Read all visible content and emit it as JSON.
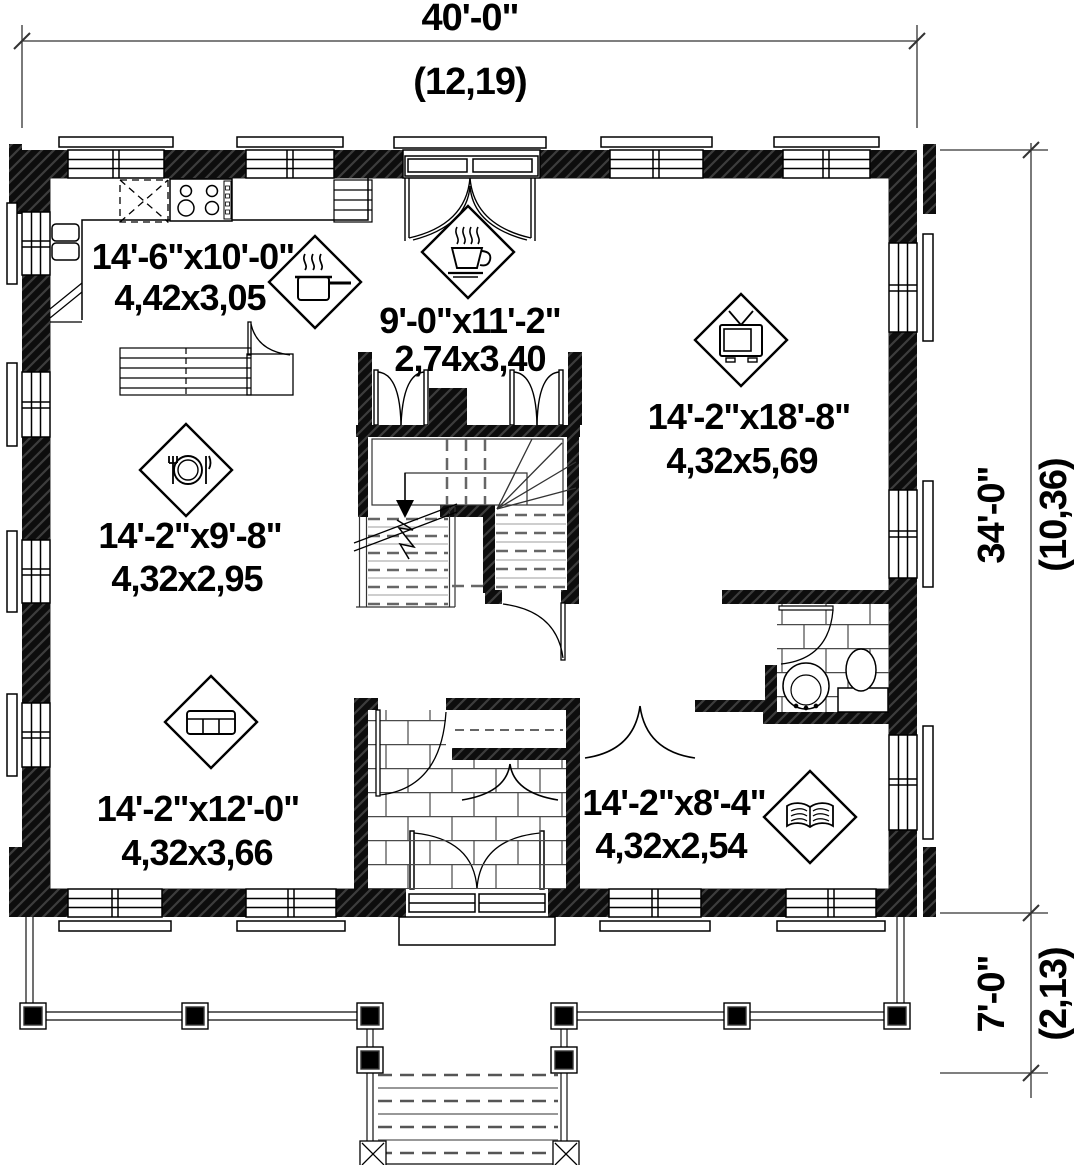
{
  "plan": {
    "type": "first-floor-plan",
    "dimensions": {
      "overall_width": {
        "imperial": "40'-0\"",
        "metric": "(12,19)"
      },
      "main_depth": {
        "imperial": "34'-0\"",
        "metric": "(10,36)"
      },
      "porch_depth": {
        "imperial": "7'-0\"",
        "metric": "(2,13)"
      }
    },
    "rooms": [
      {
        "name": "kitchen",
        "icon": "cooking-pot-icon",
        "size_imperial": "14'-6\"x10'-0\"",
        "size_metric": "4,42x3,05"
      },
      {
        "name": "breakfast-nook",
        "icon": "coffee-cup-icon",
        "size_imperial": "9'-0\"x11'-2\"",
        "size_metric": "2,74x3,40"
      },
      {
        "name": "living-room",
        "icon": "tv-icon",
        "size_imperial": "14'-2\"x18'-8\"",
        "size_metric": "4,32x5,69"
      },
      {
        "name": "dining-room",
        "icon": "dining-cutlery-icon",
        "size_imperial": "14'-2\"x9'-8\"",
        "size_metric": "4,32x2,95"
      },
      {
        "name": "family-room",
        "icon": "sofa-icon",
        "size_imperial": "14'-2\"x12'-0\"",
        "size_metric": "4,32x3,66"
      },
      {
        "name": "study",
        "icon": "open-book-icon",
        "size_imperial": "14'-2\"x8'-4\"",
        "size_metric": "4,32x2,54"
      }
    ],
    "colors": {
      "wall": "#0d0d0d",
      "line": "#000000",
      "background": "#ffffff"
    }
  }
}
